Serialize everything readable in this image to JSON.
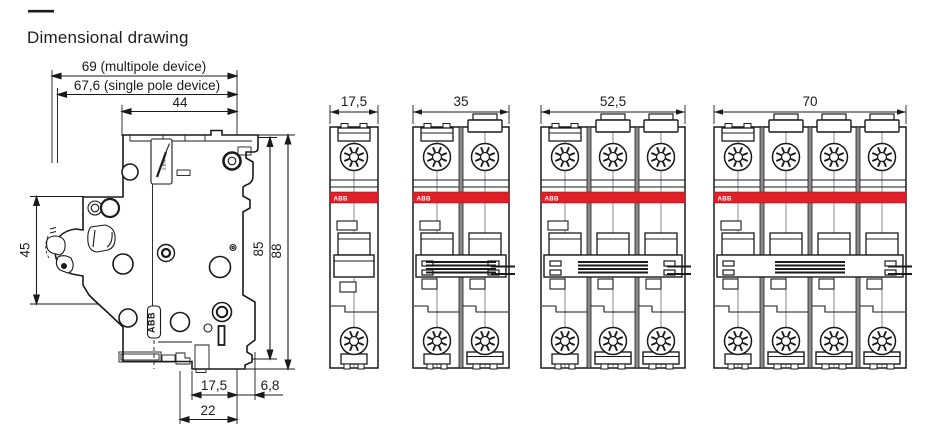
{
  "header": {
    "dash": "—",
    "title": "Dimensional drawing"
  },
  "colors": {
    "line": "#1a1a1a",
    "accent_red": "#e01f26",
    "separator_gray": "#8a8a8a",
    "band_text": "#ffffff"
  },
  "side_view": {
    "dims": {
      "multipole_width": "69 (multipole device)",
      "single_pole_width": "67,6 (single pole device)",
      "front_width": "44",
      "handle_height": "45",
      "body_height": "85",
      "total_height": "88",
      "base_depth": "17,5",
      "rail_offset": "6,8",
      "base_full_depth": "22"
    },
    "markings": {
      "brand": "ABB",
      "torque": "2.8Nm"
    }
  },
  "front_views": {
    "brand": "ABB",
    "views": [
      {
        "name": "1-pole",
        "poles": 1,
        "width_label": "17,5"
      },
      {
        "name": "2-pole",
        "poles": 2,
        "width_label": "35"
      },
      {
        "name": "3-pole",
        "poles": 3,
        "width_label": "52,5"
      },
      {
        "name": "4-pole",
        "poles": 4,
        "width_label": "70"
      }
    ]
  }
}
